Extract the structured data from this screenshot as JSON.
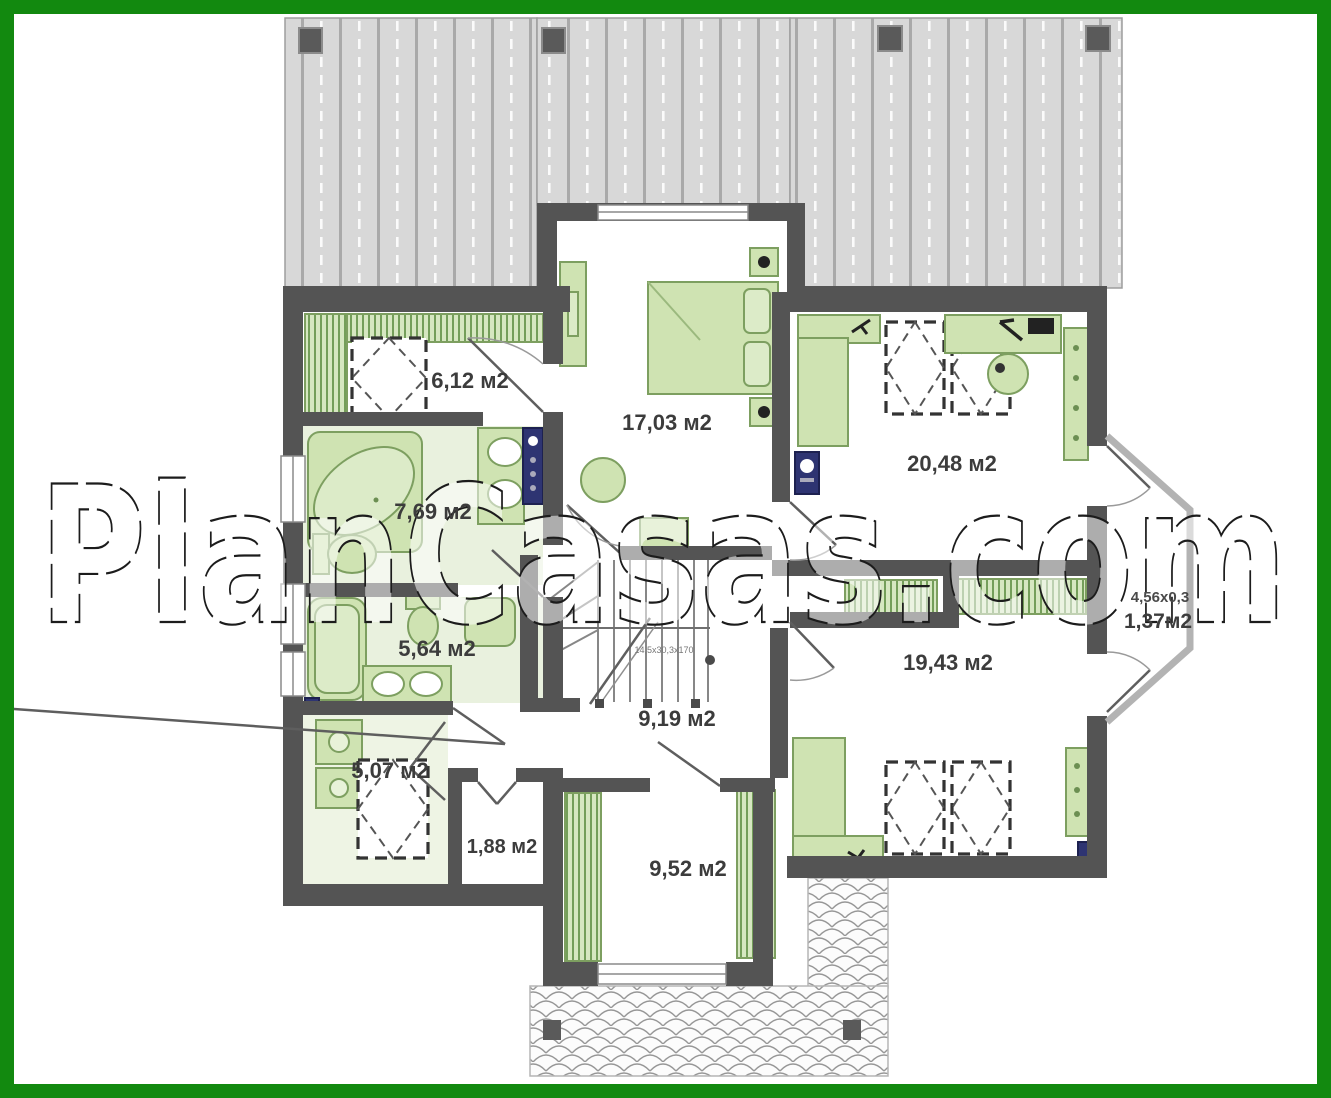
{
  "watermark": {
    "text": "PlanCasas.com"
  },
  "plan": {
    "rooms": [
      {
        "id": "closet-top-left",
        "area_label": "6,12 м2"
      },
      {
        "id": "bathroom-main",
        "area_label": "7,69 м2"
      },
      {
        "id": "bathroom-second",
        "area_label": "5,64 м2"
      },
      {
        "id": "laundry-room",
        "area_label": "5,07 м2"
      },
      {
        "id": "small-storage",
        "area_label": "1,88 м2"
      },
      {
        "id": "stair-hall",
        "area_label": "9,19 м2"
      },
      {
        "id": "bedroom-top-center",
        "area_label": "17,03 м2"
      },
      {
        "id": "bedroom-top-right",
        "area_label": "20,48 м2"
      },
      {
        "id": "bedroom-bottom-right",
        "area_label": "19,43 м2"
      },
      {
        "id": "dressing-room",
        "area_label": "9,52 м2"
      }
    ],
    "balcony": {
      "dimension_label": "4,56x0,3",
      "area_label": "1,37м2"
    },
    "stairs": {
      "note": "14,5x30,3x170"
    }
  },
  "colors": {
    "frame_green": "#12890f",
    "wall_gray": "#545454",
    "roof_gray": "#d8d8d8",
    "furniture_green_fill": "#cfe3b2",
    "furniture_green_stroke": "#7d9f60",
    "bathroom_tint": "#e9f1de",
    "navy_fixture": "#2e3472",
    "label_text": "#3c3c3c"
  }
}
